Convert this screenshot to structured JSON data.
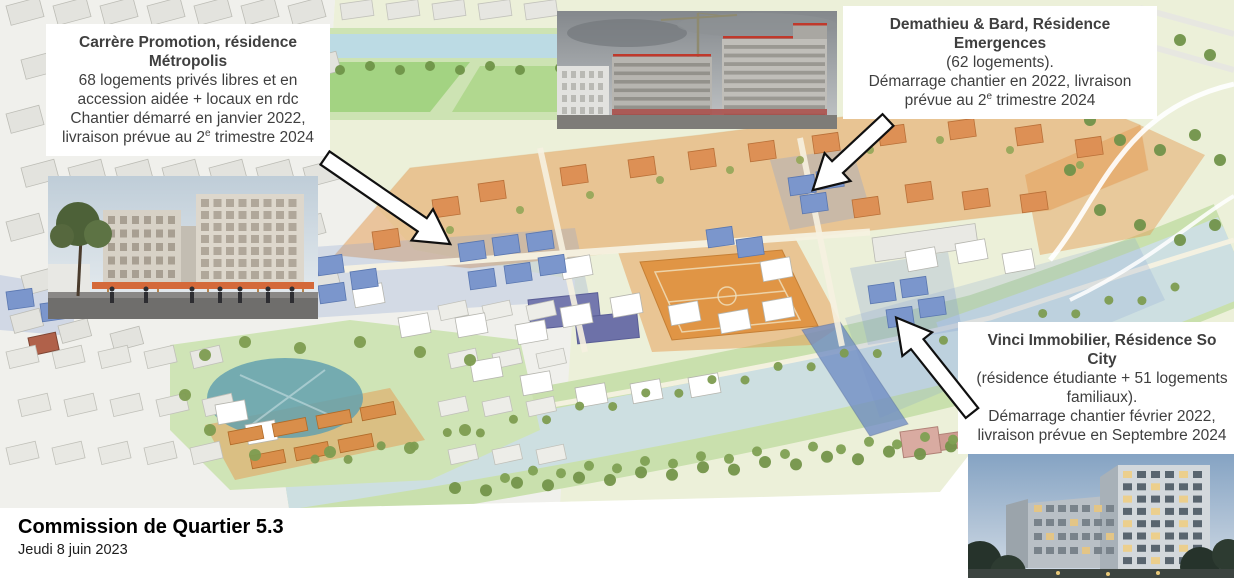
{
  "footer": {
    "title": "Commission de Quartier 5.3",
    "date": "Jeudi 8 juin 2023"
  },
  "callouts": [
    {
      "id": "carrere-metropolis",
      "heading1": "Carrère Promotion, résidence",
      "heading2": "Métropolis",
      "line1": "68 logements privés libres et en",
      "line2": "accession aidée + locaux en rdc",
      "line3": "Chantier démarré en janvier 2022,",
      "line4_pre": "livraison prévue au 2",
      "line4_sup": "e",
      "line4_post": " trimestre 2024"
    },
    {
      "id": "demathieu-emergences",
      "heading1": "Demathieu & Bard, Résidence",
      "heading2": "Emergences",
      "line1": "(62 logements).",
      "line2": "Démarrage chantier en 2022, livraison",
      "line3_pre": "prévue au 2",
      "line3_sup": "e",
      "line3_post": " trimestre 2024"
    },
    {
      "id": "vinci-so-city",
      "heading1": "Vinci Immobilier, Résidence So",
      "heading2": "City",
      "line1": "(résidence étudiante + 51 logements",
      "line2": "familiaux).",
      "line3": "Démarrage chantier février 2022,",
      "line4": "livraison prévue en Septembre 2024"
    }
  ],
  "images": [
    {
      "alt": "photo chantier Résidence Emergences"
    },
    {
      "alt": "perspective résidence Métropolis"
    },
    {
      "alt": "perspective Résidence So City"
    }
  ],
  "pointers": [
    {
      "id": "arrow-1",
      "direction": "down-right"
    },
    {
      "id": "arrow-2",
      "direction": "down-left"
    },
    {
      "id": "arrow-3",
      "direction": "up-left"
    }
  ],
  "map": {
    "type": "3d-masterplan",
    "colors": {
      "existing_city": "#e3e3de",
      "pale_ground": "#ecf0d9",
      "park_green": "#cde3b3",
      "orange_zone": "#e59a4f",
      "sports_field": "#e0923f",
      "blue_buildings": "#7b96cc",
      "bridge_blue": "#6f8cc4",
      "river": "#cddfe1",
      "pond": "#5f9fae",
      "tree_green": "#7d9c50",
      "school_slate": "#7478ae"
    }
  }
}
